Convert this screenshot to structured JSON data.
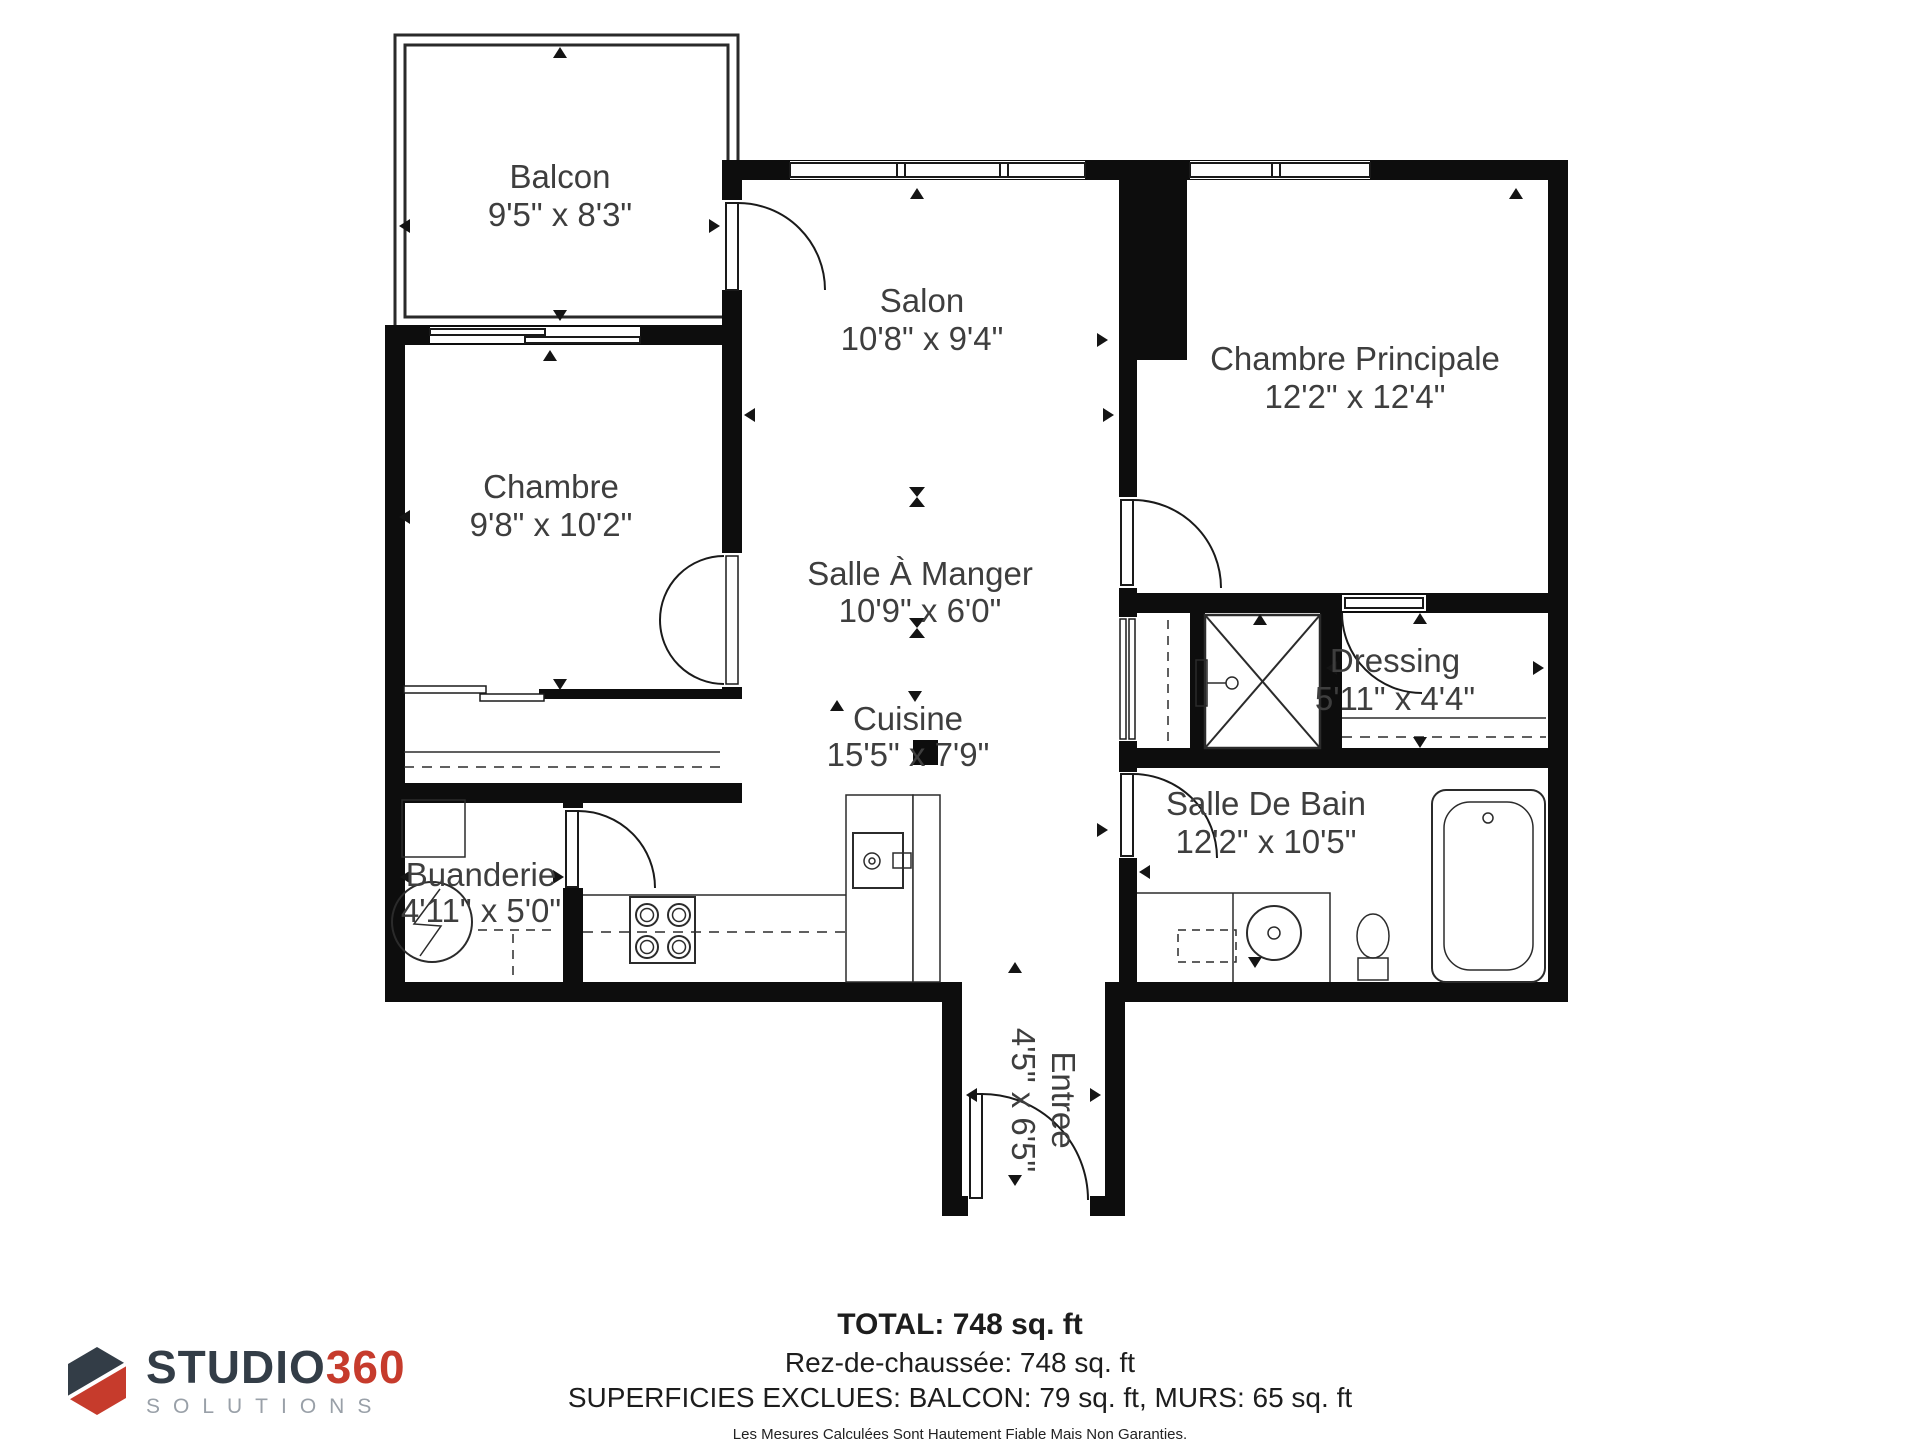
{
  "floor_plan": {
    "rooms": [
      {
        "id": "balcon",
        "name": "Balcon",
        "dims": "9'5\" x 8'3\""
      },
      {
        "id": "salon",
        "name": "Salon",
        "dims": "10'8\" x 9'4\""
      },
      {
        "id": "chambre-principale",
        "name": "Chambre Principale",
        "dims": "12'2\" x 12'4\""
      },
      {
        "id": "chambre",
        "name": "Chambre",
        "dims": "9'8\" x 10'2\""
      },
      {
        "id": "salle-a-manger",
        "name": "Salle À Manger",
        "dims": "10'9\" x 6'0\""
      },
      {
        "id": "cuisine",
        "name": "Cuisine",
        "dims": "15'5\" x 7'9\""
      },
      {
        "id": "dressing",
        "name": "Dressing",
        "dims": "5'11\" x 4'4\""
      },
      {
        "id": "salle-de-bain",
        "name": "Salle De Bain",
        "dims": "12'2\" x 10'5\""
      },
      {
        "id": "buanderie",
        "name": "Buanderie",
        "dims": "4'11\" x 5'0\""
      },
      {
        "id": "entree",
        "name": "Entree",
        "dims": "4'5\" x 6'5\""
      }
    ],
    "palette": {
      "wall": "#0d0d0d",
      "line": "#1a1a1a",
      "label_text": "#3e3e3e"
    }
  },
  "summary": {
    "total": "TOTAL: 748 sq. ft",
    "floor_line": "Rez-de-chaussée: 748 sq. ft",
    "exclusions_line": "SUPERFICIES EXCLUES: BALCON: 79 sq. ft, MURS: 65 sq. ft",
    "disclaimer": "Les Mesures Calculées Sont Hautement Fiable Mais Non Garanties."
  },
  "logo": {
    "brand": "STUDIO",
    "brand_number": "360",
    "subtitle": "SOLUTIONS",
    "colors": {
      "brand": "#333d47",
      "number": "#c63b2c",
      "subtitle": "#99a0a8"
    }
  }
}
